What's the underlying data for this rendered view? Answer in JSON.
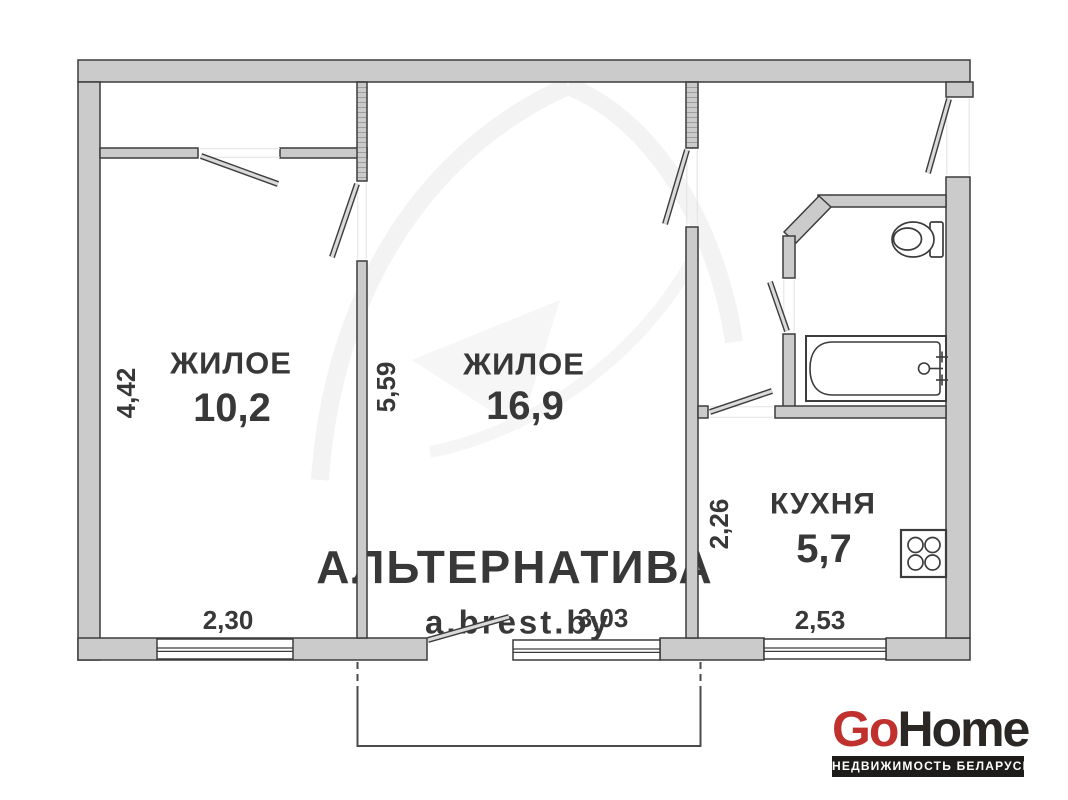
{
  "rooms": [
    {
      "label": "ЖИЛОЕ",
      "area": "10,2",
      "dim_bottom": "2,30",
      "dim_side": "4,42"
    },
    {
      "label": "ЖИЛОЕ",
      "area": "16,9",
      "dim_bottom": "3,03",
      "dim_side": "5,59"
    },
    {
      "label": "КУХНЯ",
      "area": "5,7",
      "dim_bottom": "2,53",
      "dim_side": "2,26"
    }
  ],
  "fixtures": [
    "toilet",
    "bathtub",
    "stove-4-burner"
  ],
  "features": [
    "balcony",
    "entrance-door-top-right",
    "bathroom-chamfered-corner",
    "3-windows"
  ],
  "watermark": {
    "brand": "АЛЬТЕРНАТИВА",
    "site": "a.brest.by"
  },
  "logo": {
    "go": "Go",
    "home": "Home",
    "tagline": "НЕДВИЖИМОСТЬ БЕЛАРУСИ"
  },
  "colors": {
    "wall_fill": "#cbcbcb",
    "wall_outline": "#3c3c3c",
    "label_text": "#383838",
    "watermark_gray": "#eeeeee",
    "logo_red": "#c0312e",
    "logo_dark": "#2a2725",
    "tagline_bg": "#1d1c1a"
  }
}
